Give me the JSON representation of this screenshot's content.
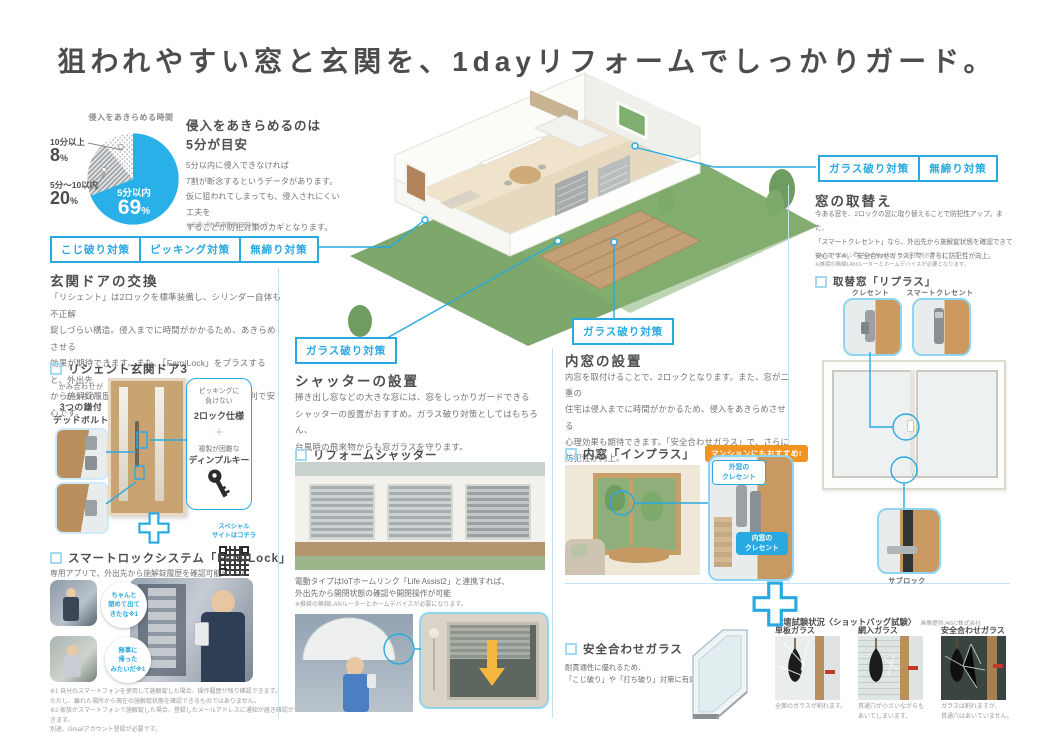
{
  "title": "狙われやすい窓と玄関を、1dayリフォームでしっかりガード。",
  "colors": {
    "accent": "#29a9e1",
    "orange": "#f29421"
  },
  "pie": {
    "caption": "侵入をあきらめる時間",
    "over10_label": "10分以上",
    "over10_num": "8",
    "mid_label": "5分〜10以内",
    "mid_num": "20",
    "in5_label": "5分以内",
    "in5_num": "69",
    "unit": "%"
  },
  "chart_data": {
    "type": "pie",
    "title": "侵入をあきらめる時間",
    "categories": [
      "5分以内",
      "5分〜10以内",
      "10分以上"
    ],
    "values": [
      69,
      20,
      8
    ],
    "unit": "%",
    "legend_position": "outside-left",
    "source": "※出典:(財)都市防犯研究センター"
  },
  "intro": {
    "head1": "侵入をあきらめるのは",
    "head2": "5分が目安",
    "body": "5分以内に侵入できなければ\n7割が断念するというデータがあります。\n仮に狙われてしまっても、侵入されにくい工夫を\nすることが防犯対策のカギとなります。",
    "source": "※出典:(財)都市防犯研究センター"
  },
  "door": {
    "tags": [
      "こじ破り対策",
      "ピッキング対策",
      "無締り対策"
    ],
    "heading": "玄関ドアの交換",
    "body": "「リシェント」は2ロックを標準装備し、シリンダー自体も不正解\n錠しづらい構造。侵入までに時間がかかるため、あきらめさせる\n効果が期待できます。また、「FamiLock」をプラスすると、外出先\nから施解錠履歴を確認※1・2できるなど、さらに便利で安心です。",
    "product": "リシェント玄関ドア3",
    "bolt_small": "かみ合わせが\nがっちり",
    "bolt_bold": "3つの鎌付\nデッドボルト",
    "lock_small": "ピッキングに\n負けない",
    "lock_bold": "2ロック仕様",
    "key_small": "複製が困難な",
    "key_bold": "ディンプルキー"
  },
  "famiLock": {
    "product": "スマートロックシステム「FamiLock」",
    "lead": "専用アプリで、外出先から施解錠履歴を確認可能※1・2",
    "qr_label": "スペシャル\nサイトはコチラ",
    "bubble1": "ちゃんと\n閉めて出て\nきたな※1",
    "bubble2": "無事に\n帰った\nみたいだ※1",
    "notes": "※1 自分のスマートフォンを使用して施解錠した場合、操作履歴が残り確認できます。\nただし、離れた場所から現在の施解錠状態を確認できるものではありません。\n※2 家族がスマートフォンで施解錠した場合、登録したメールアドレスに通知が届き確認ができます。\n別途、Gmailアカウント登録が必要です。"
  },
  "shutter": {
    "tag": "ガラス破り対策",
    "heading": "シャッターの設置",
    "body": "掃き出し窓などの大きな窓には、窓をしっかりガードできる\nシャッターの設置がおすすめ。ガラス破り対策としてはもちろん、\n台風時の飛来物からも窓ガラスを守ります。",
    "product": "リフォームシャッター",
    "iot": "電動タイプはIoTホームリンク「Life Assist2」と連携すれば、\n外出先から開閉状態の確認や開閉操作が可能",
    "iot_note": "※推奨の無線LANルーターとホームデバイスが必要になります。"
  },
  "inner": {
    "tag": "ガラス破り対策",
    "heading": "内窓の設置",
    "body": "内窓を取付けることで、2ロックとなります。また、窓が二重の\n住宅は侵入までに時間がかかるため、侵入をあきらめさせる\n心理効果も期待できます。「安全合わせガラス」で、さらに\n防犯性が向上。",
    "product": "内窓「インプラス」",
    "badge": "マンションにもおすすめ!",
    "outer_label": "外窓の\nクレセント",
    "inner_label": "内窓の\nクレセント"
  },
  "replace": {
    "tags": [
      "ガラス破り対策",
      "無締り対策"
    ],
    "heading": "窓の取替え",
    "body": "今ある窓を、2ロックの窓に取り替えることで防犯性アップ。また、\n「スマートクレセント」なら、外出先から施解錠状態を確認できて\n安心です※。「安全合わせガラス」で、さらに防犯性が向上。",
    "notes": "※IoTホームリンク「Life Assist2」との連携が必要です。\n※推奨の無線LANルーターとホームデバイスが必要となります。",
    "product": "取替窓「リプラス」",
    "crescent": "クレセント",
    "smart_crescent": "スマートクレセント",
    "sublock": "サブロック"
  },
  "glass": {
    "product": "安全合わせガラス",
    "body": "耐貫通性に優れるため、\n「こじ破り」や「打ち破り」対策に有効",
    "test_title": "破壊試験状況〈ショットバッグ試験〉",
    "credit": "画像提供:AGC株式会社",
    "tests": [
      {
        "name": "単板ガラス",
        "caption": "全面のガラスが割れます。"
      },
      {
        "name": "網入ガラス",
        "caption": "貫通穴が小さいながらも\nあいてしまいます。"
      },
      {
        "name": "安全合わせガラス",
        "caption": "ガラスは割れますが、\n貫通穴はあいていません。"
      }
    ]
  }
}
